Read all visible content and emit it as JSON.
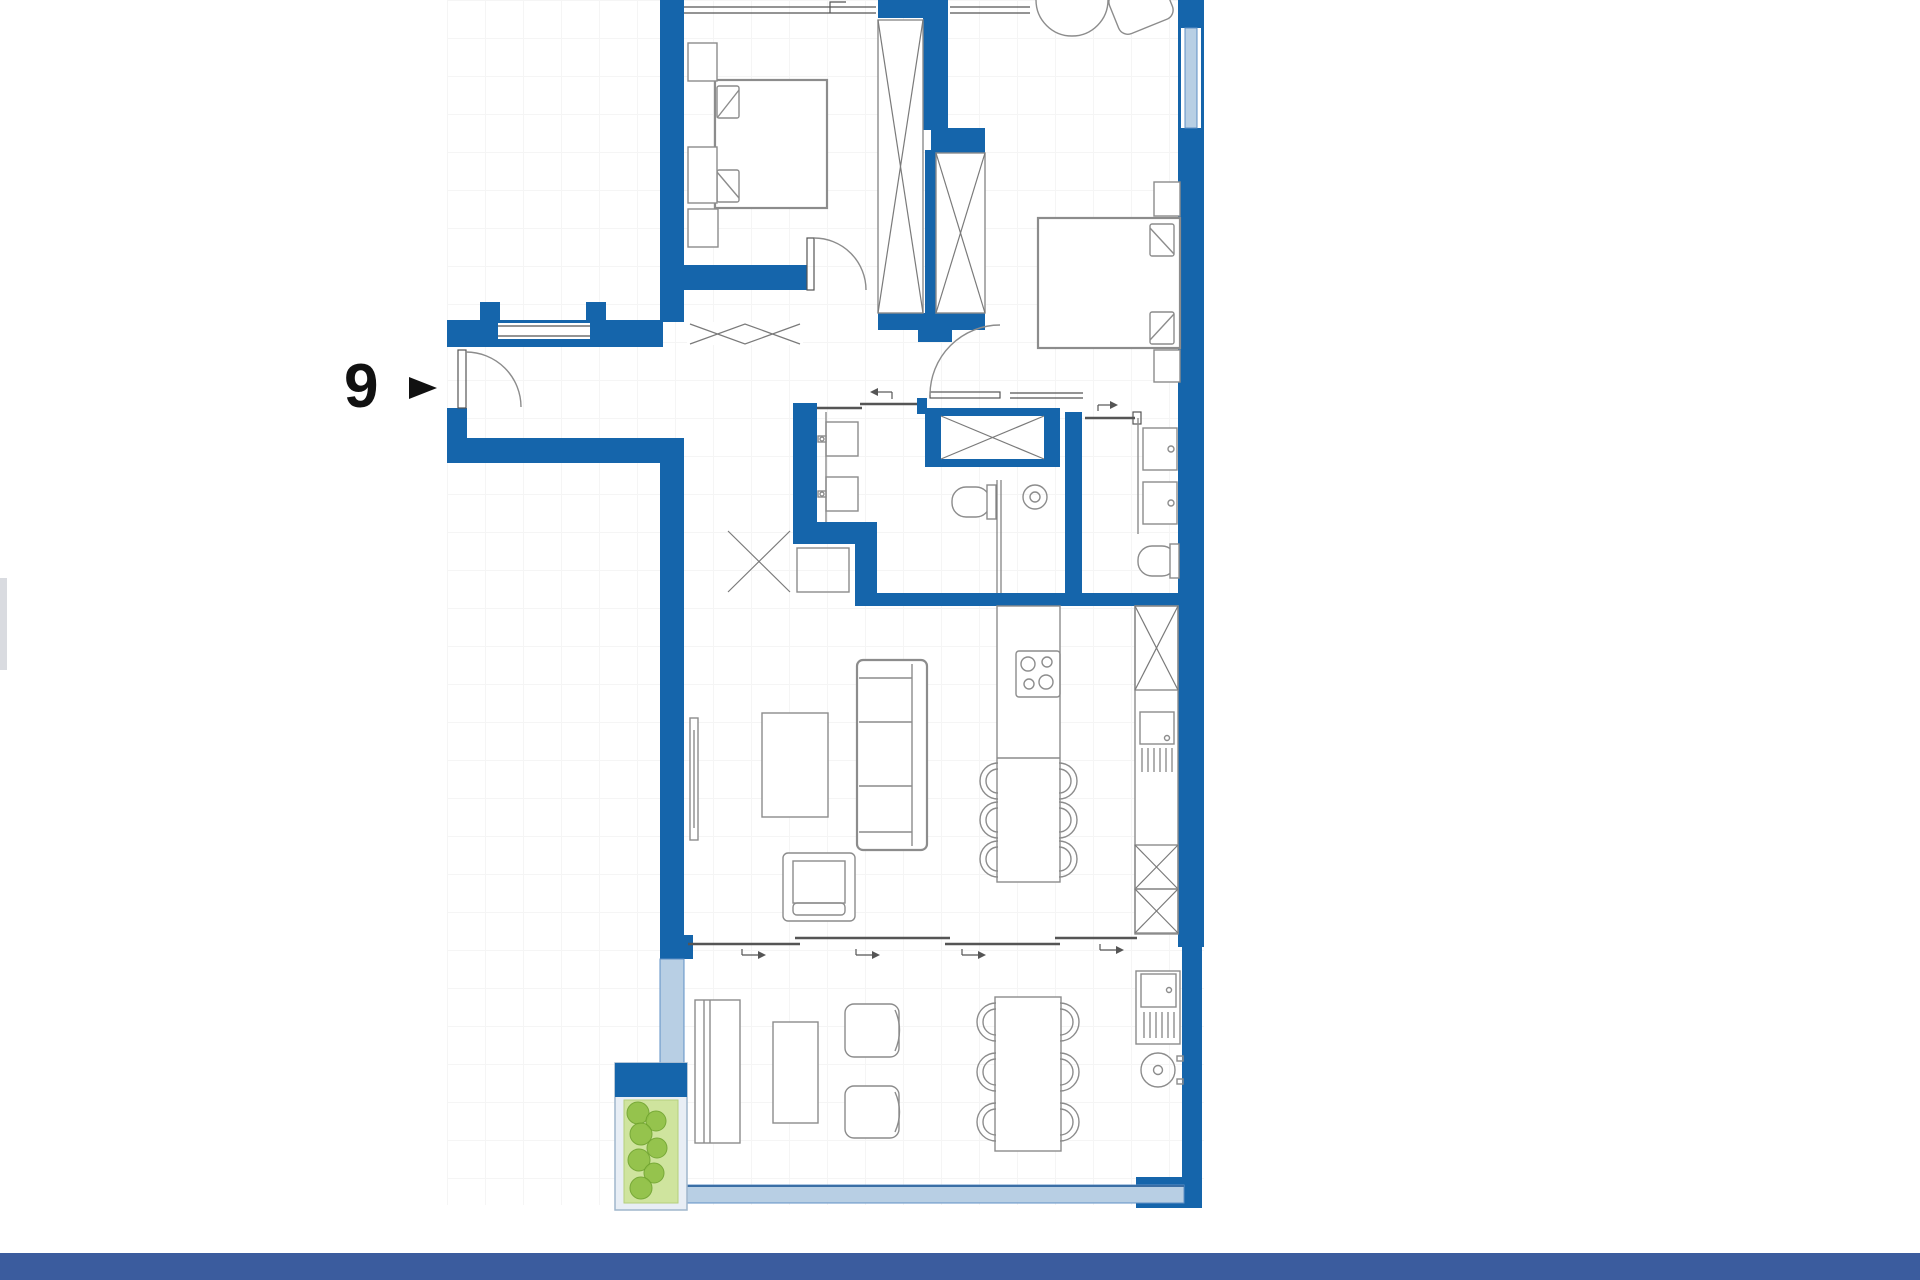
{
  "page": {
    "background_color": "#ffffff",
    "footer_bar_color": "#3b5c9e"
  },
  "unit_label": {
    "number": "9",
    "marker_icon": "right-arrow-marker",
    "color": "#111111"
  },
  "palette": {
    "wall": "#1565ab",
    "window_glass": "#b8cfe4",
    "window_frame": "#5e8fc4",
    "furniture_line": "#8c8c8c",
    "detail_line": "#555555",
    "planter_bed": "#cfe49e",
    "plant": "#8fc045",
    "plant_edge": "#6fa32e"
  },
  "floor_plan": {
    "type": "apartment-floor-plan",
    "rooms": [
      {
        "name": "bedroom-1",
        "furniture": [
          "double-bed",
          "nightstand",
          "nightstand",
          "dresser",
          "wardrobe-x"
        ]
      },
      {
        "name": "bedroom-2",
        "furniture": [
          "double-bed",
          "nightstand",
          "nightstand",
          "round-chair",
          "lounge-seat",
          "wardrobe-x"
        ]
      },
      {
        "name": "bathroom-1",
        "furniture": [
          "double-vanity",
          "toilet",
          "shower-tray",
          "floor-drain"
        ]
      },
      {
        "name": "bathroom-2",
        "furniture": [
          "double-vanity",
          "toilet"
        ]
      },
      {
        "name": "hallway",
        "furniture": [
          "entrance-door",
          "coat-rack",
          "duct-shaft-x",
          "cross-mark"
        ]
      },
      {
        "name": "living-kitchen",
        "furniture": [
          "sofa",
          "coffee-table",
          "armchair",
          "tv-unit",
          "kitchen-island",
          "cooktop",
          "dining-chairs-6",
          "tall-cabinet-x",
          "kitchen-sink",
          "dishwasher",
          "fridge-cabinets-x"
        ]
      },
      {
        "name": "terrace",
        "furniture": [
          "console-table",
          "side-table",
          "lounge-chair",
          "lounge-chair",
          "outdoor-dining-table",
          "dining-chairs-6",
          "outdoor-sink-unit",
          "barbecue-grill",
          "planter"
        ]
      }
    ],
    "features": [
      "windows",
      "sliding-glass-doors",
      "balcony-railing"
    ]
  }
}
